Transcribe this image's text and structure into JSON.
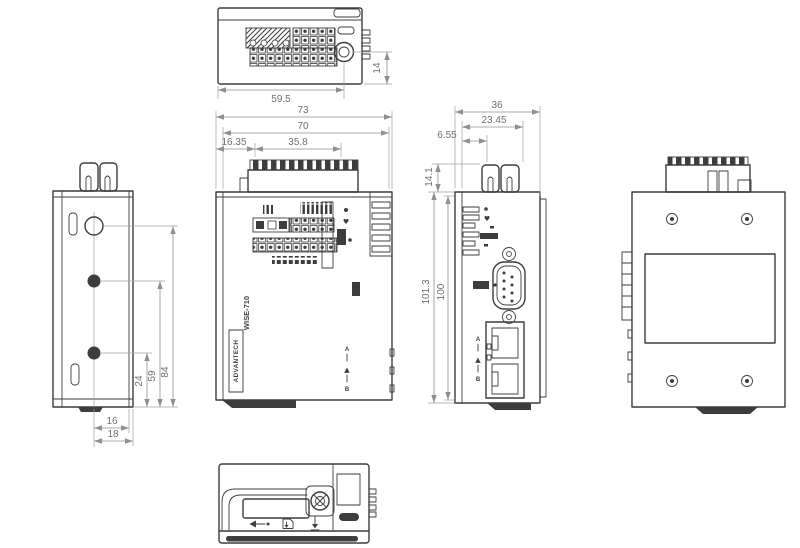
{
  "drawing_title": "WISE-710 outline dimensional drawing",
  "colors": {
    "line": "#3d3d3d",
    "dim_line": "#8f8f8f",
    "dim_text": "#6f6f6f",
    "background": "#ffffff"
  },
  "views": {
    "top": {
      "dims": {
        "width": "59.5",
        "antenna_to_edge": "14"
      }
    },
    "front": {
      "dims": {
        "overall_width": "73",
        "body_width": "70",
        "terminal_offset": "16.35",
        "terminal_width": "35.8"
      },
      "labels": {
        "brand": "ADVANTECH",
        "model": "WISE-710",
        "rail_a": "A",
        "rail_b": "B"
      }
    },
    "side": {
      "dims": {
        "overall_depth": "36",
        "terminal_depth": "23.45",
        "front_offset": "6.55",
        "terminal_height": "14.1",
        "overall_height": "101.3",
        "body_height": "100"
      },
      "labels": {
        "eth_a": "A",
        "eth_b": "B"
      }
    },
    "left": {
      "dims": {
        "top_hole_to_base": "84",
        "mid_hole_to_base": "59",
        "lower_hole_to_base": "24",
        "center_to_inner_edge": "16",
        "center_to_outer_edge": "18"
      }
    },
    "right": {
      "dims": {}
    },
    "bottom": {
      "dims": {}
    }
  },
  "glyphs": {
    "heart": "♥",
    "triangle": "▲"
  }
}
